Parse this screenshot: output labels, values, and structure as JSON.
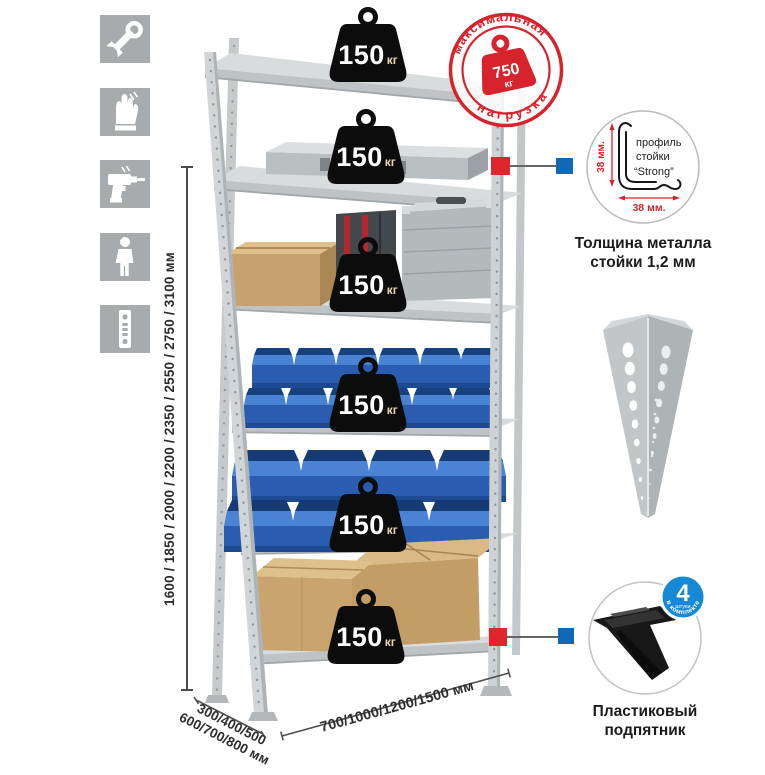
{
  "sidebar": {
    "icons": [
      {
        "name": "wrench"
      },
      {
        "name": "work-gloves"
      },
      {
        "name": "drill"
      },
      {
        "name": "person-height"
      },
      {
        "name": "perforated-rack-profile"
      }
    ]
  },
  "dimensions": {
    "height": "1600 / 1850 / 2000 / 2200 / 2350 / 2550 / 2750 / 3100 мм",
    "width": "700/1000/1200/1500 мм",
    "depth_line1": "300/400/500",
    "depth_line2": "600/700/800 мм"
  },
  "shelf_weights": [
    {
      "value": "150",
      "unit": "кг"
    },
    {
      "value": "150",
      "unit": "кг"
    },
    {
      "value": "150",
      "unit": "кг"
    },
    {
      "value": "150",
      "unit": "кг"
    },
    {
      "value": "150",
      "unit": "кг"
    },
    {
      "value": "150",
      "unit": "кг"
    }
  ],
  "stamp": {
    "arc_top": "максимальная",
    "arc_bottom": "нагрузка",
    "value": "750",
    "unit": "кг"
  },
  "profile_detail": {
    "label_line1": "профиль",
    "label_line2": "стойки",
    "label_line3": "“Strong”",
    "dim_vertical": "38 мм.",
    "dim_horizontal": "38 мм.",
    "caption_line1": "Толщина металла",
    "caption_line2": "стойки 1,2 мм"
  },
  "foot_detail": {
    "badge_value": "4",
    "badge_small": "штуки",
    "badge_arc": "в комплекте",
    "caption_line1": "Пластиковый",
    "caption_line2": "подпятник"
  },
  "colors": {
    "accent_red": "#d7232b",
    "accent_blue": "#1168b5",
    "badge_blue": "#1689d6",
    "bin_blue": "#2a5cb0",
    "metal_gray": "#d2d6d8",
    "cardboard": "#c9a46f",
    "icon_tile_gray": "#a7abae"
  }
}
